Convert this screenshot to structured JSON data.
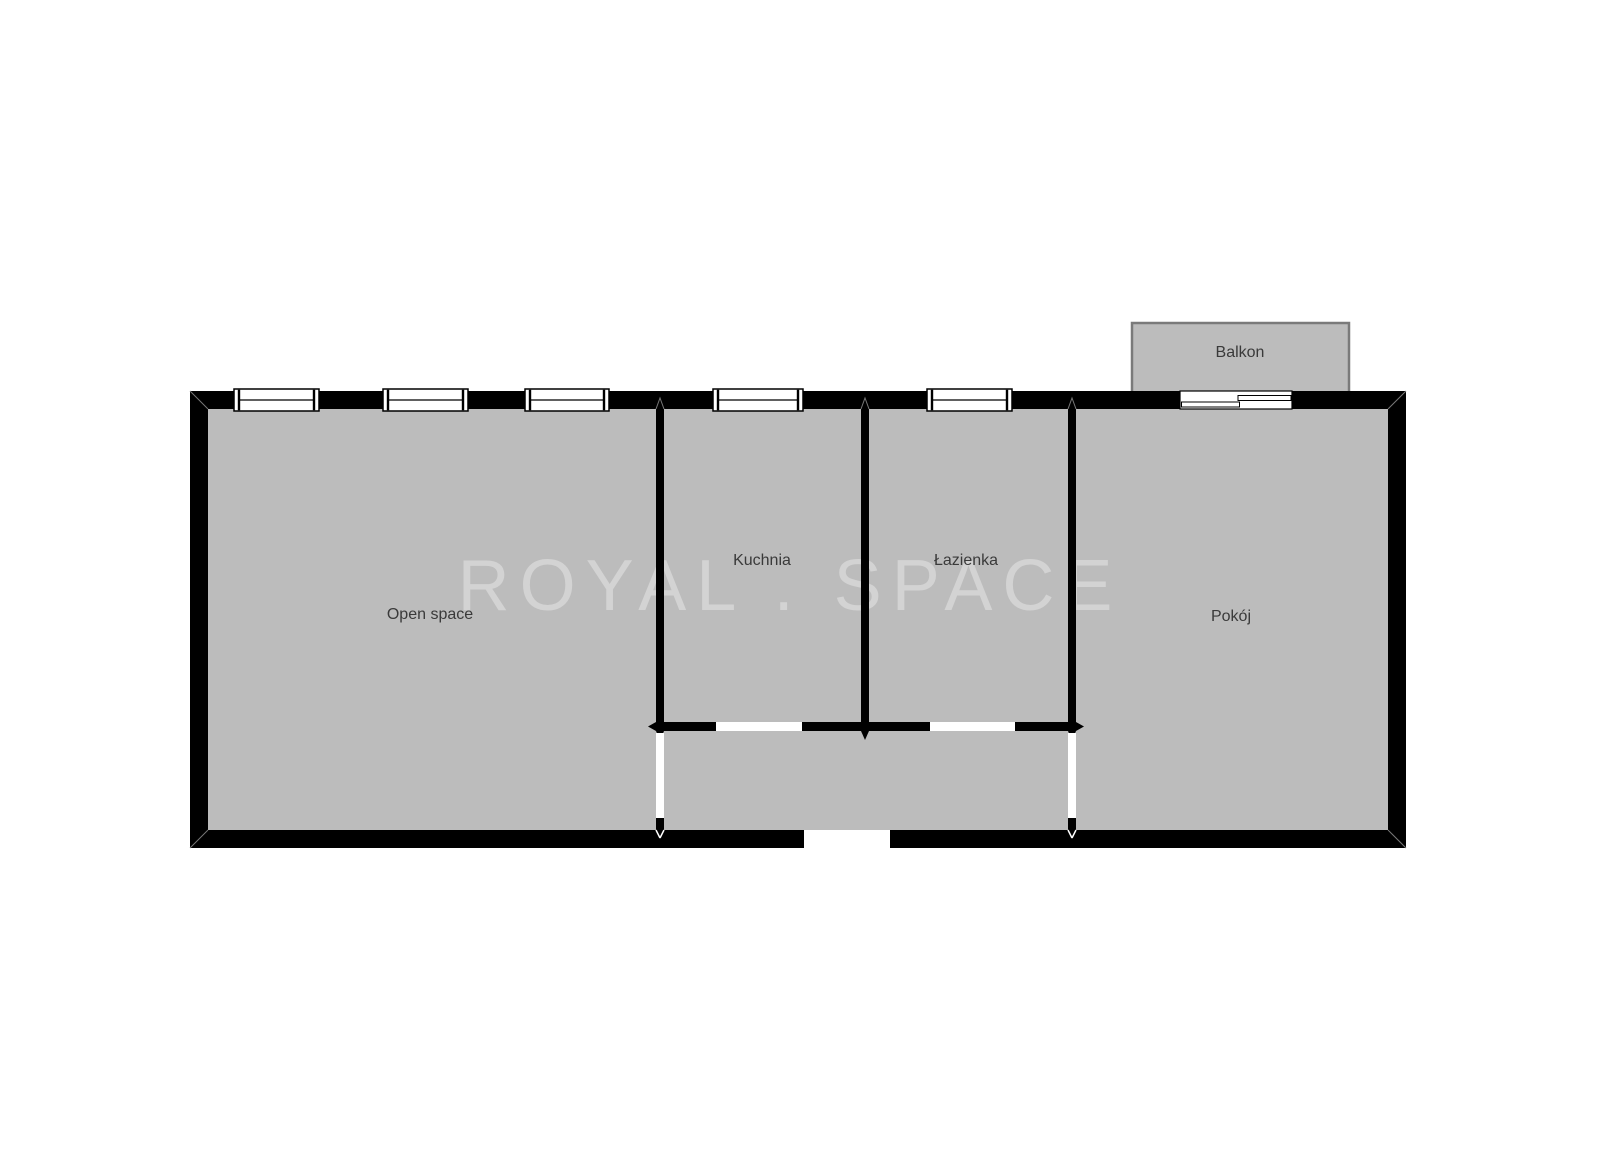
{
  "watermark": {
    "text": "ROYAL . SPACE"
  },
  "rooms": {
    "open_space": {
      "label": "Open space"
    },
    "kuchnia": {
      "label": "Kuchnia"
    },
    "lazienka": {
      "label": "Łazienka"
    },
    "pokoj": {
      "label": "Pokój"
    },
    "balkon": {
      "label": "Balkon"
    }
  },
  "icons": {
    "window_symbol": "window-icon",
    "sliding_door_symbol": "sliding-door-icon"
  },
  "colors": {
    "wall": "#000000",
    "room": "#bcbcbc",
    "opening": "#ffffff",
    "label": "#3a3a3a",
    "watermark": "#d3d3d3",
    "balcony_border": "#7a7a7a",
    "bg": "#ffffff"
  }
}
